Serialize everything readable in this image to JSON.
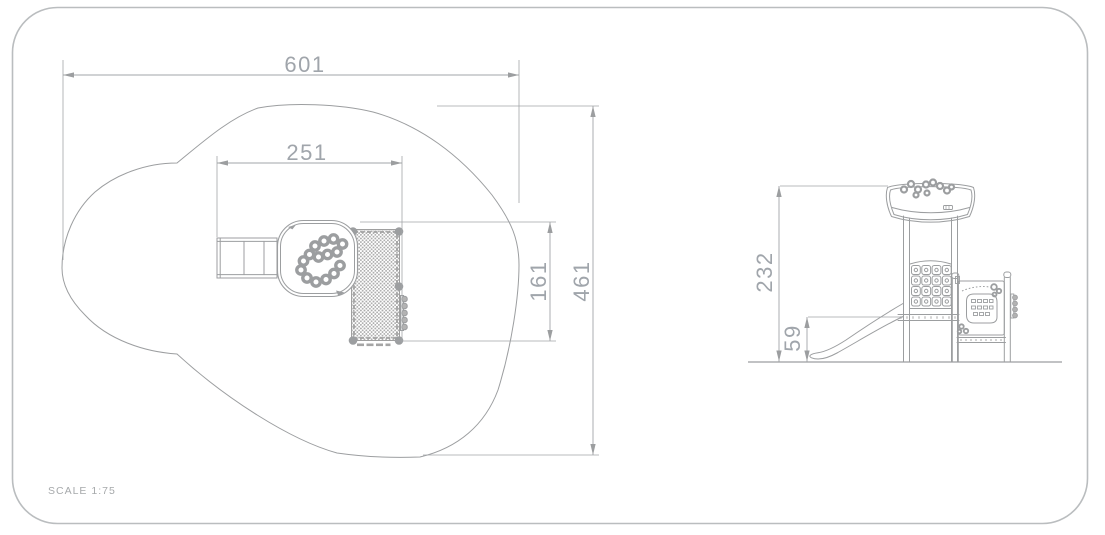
{
  "scale_label": "SCALE 1:75",
  "plan_view": {
    "dim_overall_width": "601",
    "dim_unit_width": "251",
    "dim_unit_depth": "161",
    "dim_overall_depth": "461"
  },
  "elevation_view": {
    "dim_overall_height": "232",
    "dim_platform_height": "59"
  },
  "colors": {
    "line_gray": "#9c9ea0",
    "dim_text_gray": "#a0a5ab",
    "border_gray": "#babdbf",
    "net_fill_gray": "#ababab",
    "background": "#ffffff"
  }
}
